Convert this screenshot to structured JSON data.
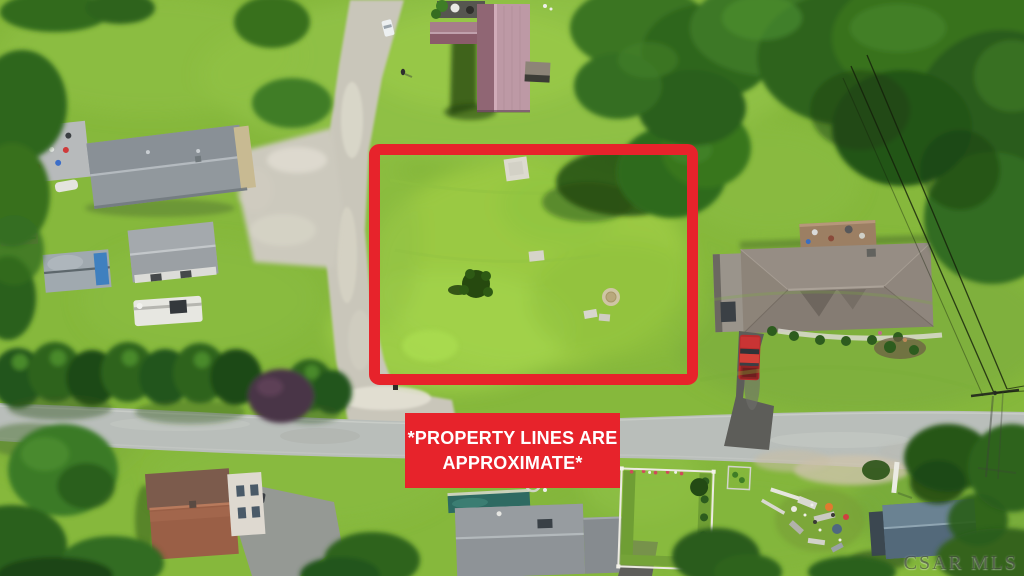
{
  "overlay": {
    "banner": {
      "line1": "*PROPERTY LINES ARE",
      "line2": "APPROXIMATE*",
      "bg_color": "#e7232b",
      "text_color": "#ffffff"
    },
    "property_box_color": "#e7232b",
    "watermark": "CSAR MLS"
  },
  "palette": {
    "red": "#e7232b",
    "grass": "#86b83c",
    "lot_grass": "#9ccb44",
    "tree_green": "#2e641e",
    "road_gray": "#b9beba",
    "gravel": "#c9c6ba"
  }
}
